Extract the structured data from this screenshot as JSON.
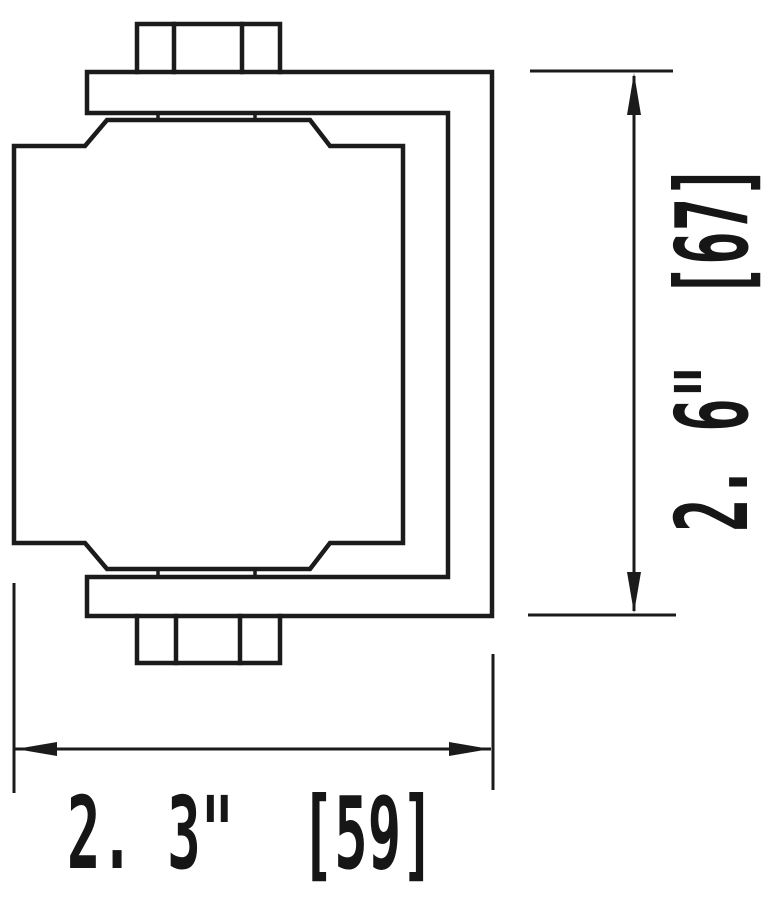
{
  "drawing": {
    "dimension_width": {
      "display": "2. 3\"  [59]",
      "inches": "2.3\"",
      "millimeters": "59"
    },
    "dimension_height": {
      "display": "2. 6\"  [67]",
      "inches": "2.6\"",
      "millimeters": "67"
    },
    "line_color": "#1b1b1b",
    "background_color": "#ffffff"
  }
}
